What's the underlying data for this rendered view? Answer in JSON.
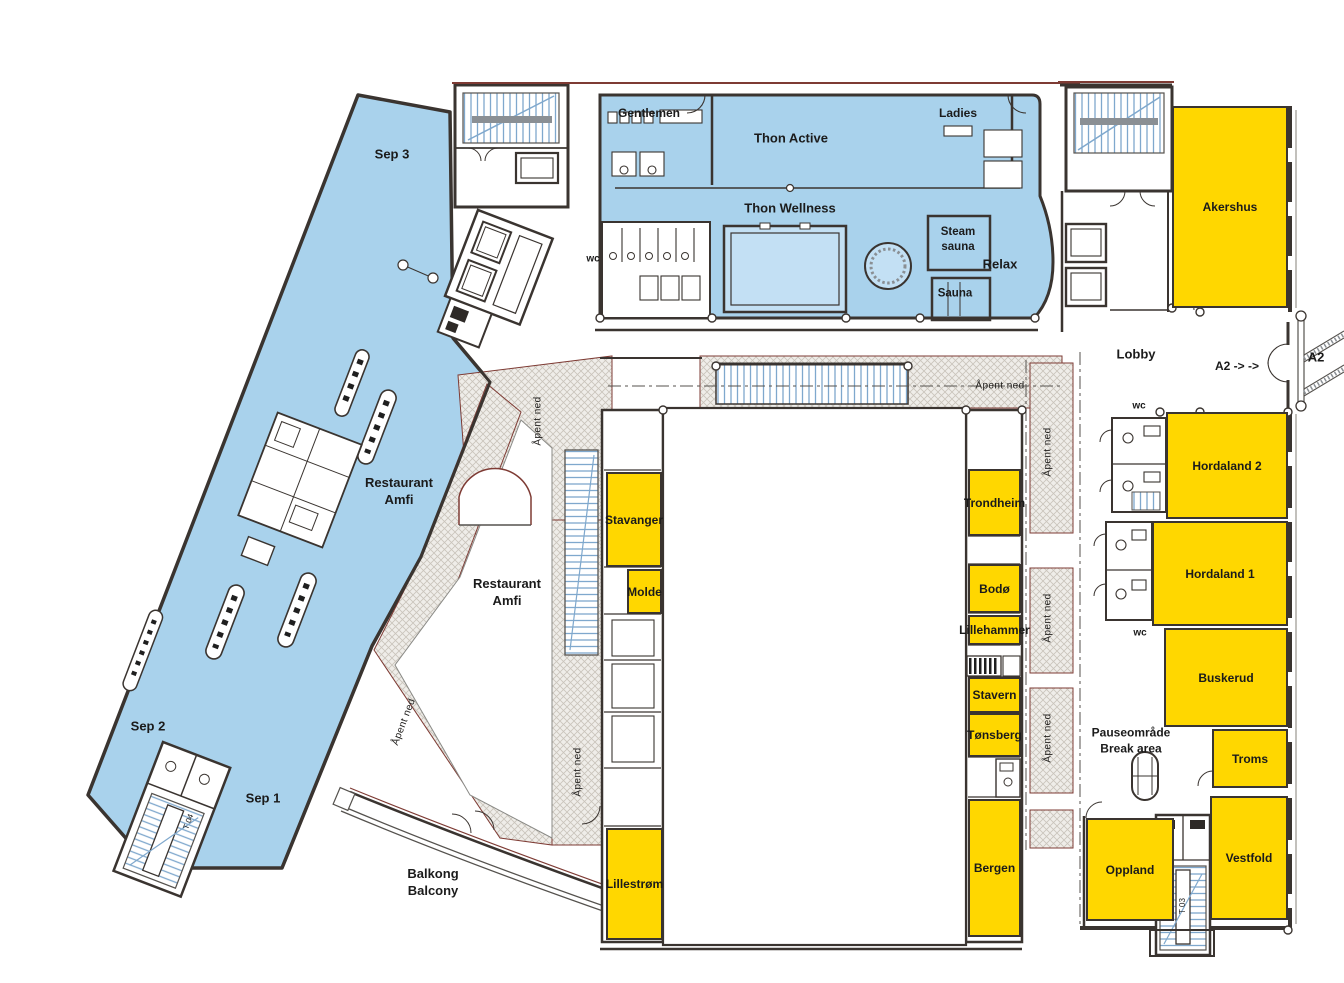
{
  "colors": {
    "zone_blue": "#a9d2ec",
    "room_yellow": "#ffd700",
    "wall": "#3a3430",
    "hatch_border": "#7e3b34",
    "stair_blue": "#7fa8cd"
  },
  "wing": {
    "sep3": "Sep 3",
    "sep2": "Sep 2",
    "sep1": "Sep 1",
    "restaurant_line1": "Restaurant",
    "restaurant_line2": "Amfi"
  },
  "restaurant_lower": {
    "line1": "Restaurant",
    "line2": "Amfi"
  },
  "balcony": {
    "line1": "Balkong",
    "line2": "Balcony"
  },
  "spa": {
    "gentlemen": "Gentlemen",
    "ladies": "Ladies",
    "thon_active": "Thon Active",
    "thon_wellness": "Thon Wellness",
    "steam_line1": "Steam",
    "steam_line2": "sauna",
    "sauna": "Sauna",
    "relax": "Relax",
    "wc": "wc"
  },
  "lobby": {
    "label": "Lobby",
    "a2_inside": "A2 -> ->",
    "a2_outside": "A2"
  },
  "rooms": {
    "akershus": "Akershus",
    "hordaland2": "Hordaland 2",
    "hordaland1": "Hordaland 1",
    "buskerud": "Buskerud",
    "troms": "Troms",
    "vestfold": "Vestfold",
    "oppland": "Oppland",
    "stavanger": "Stavanger",
    "molde": "Molde",
    "lillestrom": "Lillestrøm",
    "trondheim": "Trondheim",
    "bodo": "Bodø",
    "lillehammer": "Lillehammer",
    "stavern": "Stavern",
    "tonsberg": "Tønsberg",
    "bergen": "Bergen"
  },
  "break_area": {
    "line1": "Pauseområde",
    "line2": "Break area"
  },
  "annotations": {
    "apent_ned": "Åpent ned",
    "wc": "wc",
    "stair_t03": "T 03",
    "stair_t04": "T 04"
  }
}
